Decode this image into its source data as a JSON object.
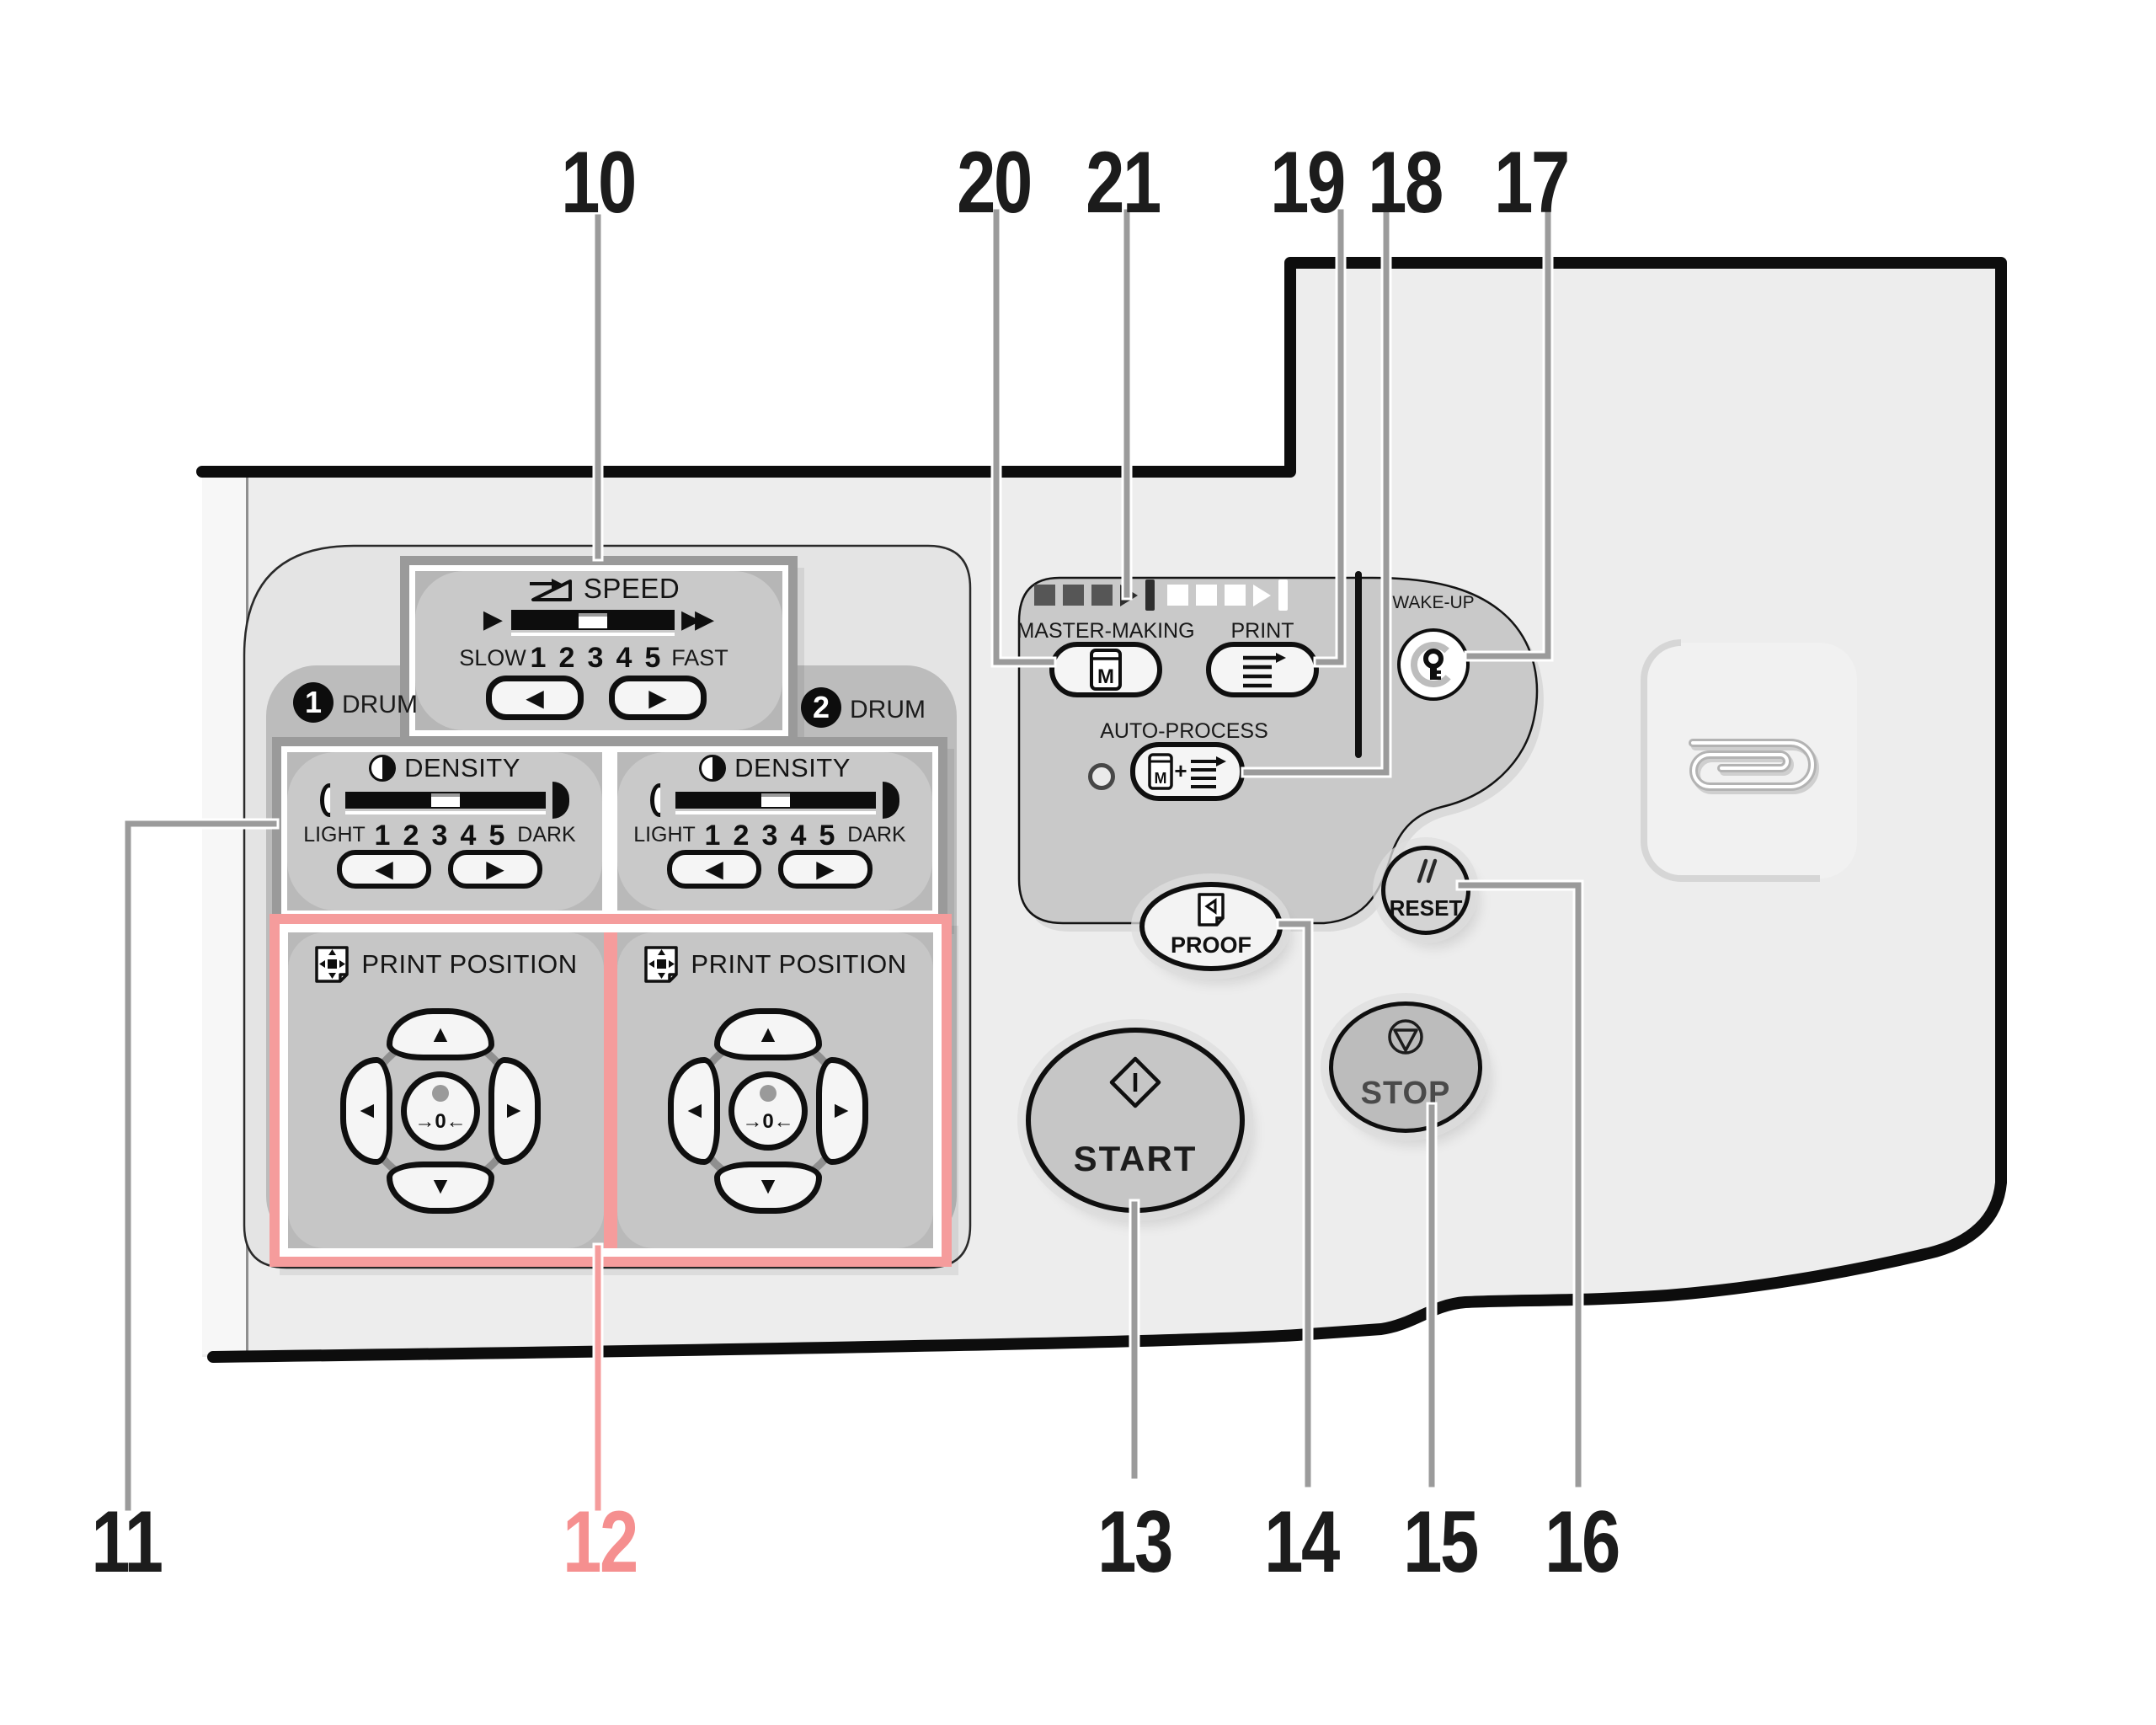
{
  "callouts": {
    "top": [
      {
        "label": "10"
      },
      {
        "label": "20"
      },
      {
        "label": "21"
      },
      {
        "label": "19"
      },
      {
        "label": "18"
      },
      {
        "label": "17"
      }
    ],
    "bottom": [
      {
        "label": "11"
      },
      {
        "label": "12"
      },
      {
        "label": "13"
      },
      {
        "label": "14"
      },
      {
        "label": "15"
      },
      {
        "label": "16"
      }
    ]
  },
  "speed": {
    "title": "SPEED",
    "slow": "SLOW",
    "fast": "FAST",
    "scale": [
      "1",
      "2",
      "3",
      "4",
      "5"
    ]
  },
  "drums": {
    "drum1_number": "1",
    "drum2_number": "2",
    "label": "DRUM"
  },
  "density": {
    "title": "DENSITY",
    "light": "LIGHT",
    "dark": "DARK",
    "scale": [
      "1",
      "2",
      "3",
      "4",
      "5"
    ]
  },
  "print_position": {
    "title": "PRINT POSITION",
    "center_label": "→0←"
  },
  "process": {
    "master_making": "MASTER-MAKING",
    "print": "PRINT",
    "auto_process": "AUTO-PROCESS",
    "wake_up": "WAKE-UP"
  },
  "round_buttons": {
    "proof": "PROOF",
    "reset": "RESET",
    "start": "START",
    "stop": "STOP"
  },
  "icons": {
    "left": "◀",
    "right": "▶",
    "up": "▲",
    "down": "▼",
    "m": "M",
    "plus": "+"
  },
  "colors": {
    "accent_pink": "#f59c9c",
    "callout_gray": "#9b9b9b",
    "body_gray": "#ededed",
    "panel_gray": "#c9c9c9",
    "black": "#0f0f0f"
  }
}
